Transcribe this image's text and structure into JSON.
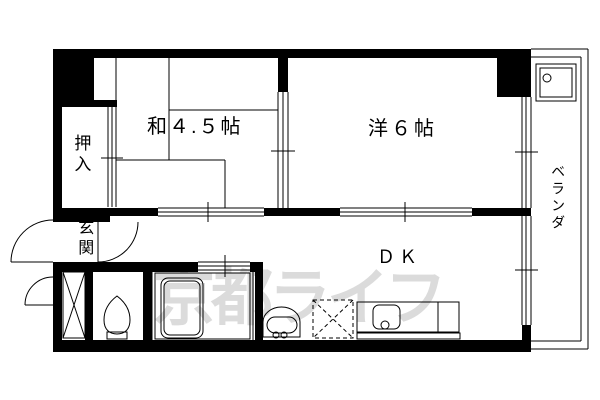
{
  "floorplan": {
    "labels": {
      "washitsu": "和４.５帖",
      "youshitsu": "洋６帖",
      "dk": "ＤＫ",
      "oshiire": "押入",
      "genkan": "玄関",
      "veranda": "ベランダ"
    },
    "watermark": {
      "text": "京都ライフ",
      "color": "#dbdbdb"
    },
    "colors": {
      "line": "#000000",
      "background": "#ffffff"
    },
    "fixtures": [
      "bathtub",
      "toilet",
      "washbasin",
      "kitchen-sink-counter",
      "refrigerator-space",
      "washing-machine-pan",
      "shoe-storage",
      "entrance-door",
      "interior-door",
      "sliding-doors",
      "windows"
    ]
  }
}
